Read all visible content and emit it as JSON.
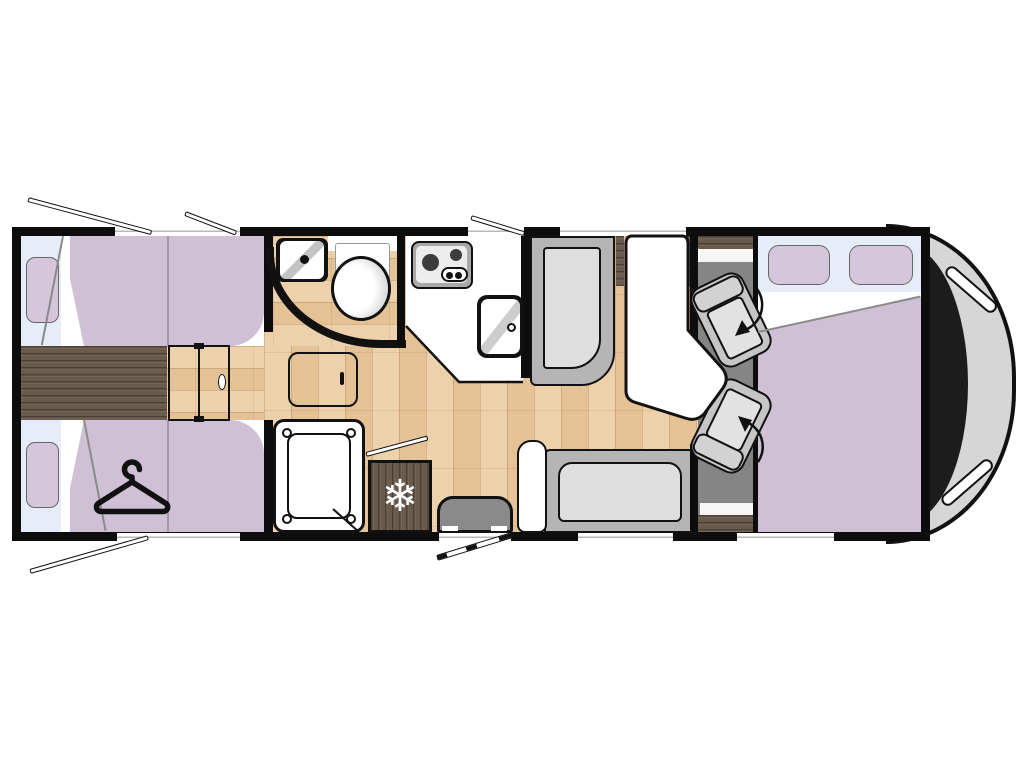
{
  "icons": {
    "snowflake_glyph": "❄",
    "hanger_icon": "clothes-hanger",
    "swivel_arrow_icon": "rotation-arrow"
  },
  "colors": {
    "wall": "#0d0d0d",
    "blanket_lavender": "#cfc0d5",
    "pillow_lavender": "#d6c6dc",
    "window_band_blue": "#e6ecf8",
    "wood_light": "#eacb9f",
    "wood_dark": "#6a5b4c",
    "cab_floor_gray": "#858585",
    "seat_gray": "#b5b5b5",
    "cushion_gray": "#dedede",
    "nose_gray": "#d6d6d6",
    "windshield_black": "#1c1c1c"
  },
  "inventory": [
    "rear single bed top",
    "rear single bed bottom with wardrobe hanger",
    "bedroom partition door",
    "bathroom corner washbasin",
    "toilet",
    "bathroom swing door",
    "shower tray",
    "kitchen two-burner hob",
    "kitchen sink",
    "refrigerator",
    "entry step with open entry door",
    "dinette forward bench",
    "dinette side bench",
    "dinette table",
    "driver swivel seat",
    "passenger swivel seat",
    "drop-down cab bed with two pillows",
    "vehicle cab front"
  ]
}
